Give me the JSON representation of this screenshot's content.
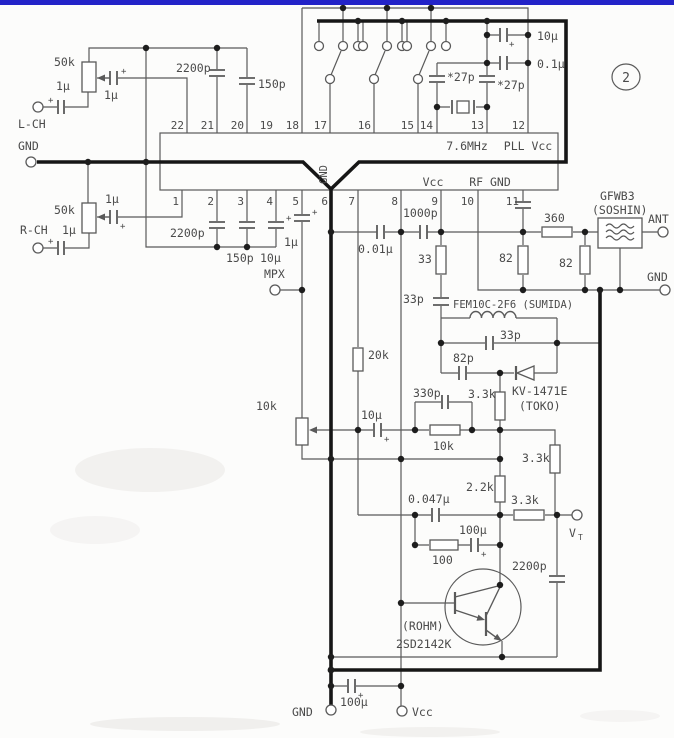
{
  "page": {
    "badge": "2"
  },
  "colors": {
    "top_bar": "#2323c8",
    "line": "#5a5a5a",
    "thick": "#161616",
    "text": "#4a4a4a"
  },
  "symbols": {
    "plus": "+"
  },
  "terminals": {
    "l_ch": "L-CH",
    "gnd_left": "GND",
    "r_ch": "R-CH",
    "mpx": "MPX",
    "vt": "V",
    "vt_sub": "T",
    "ant": "ANT",
    "gnd_right": "GND",
    "gnd_bottom": "GND",
    "vcc_bottom": "Vcc"
  },
  "ic": {
    "pins_top": [
      "22",
      "21",
      "20",
      "19",
      "18",
      "17",
      "16",
      "15",
      "14",
      "13",
      "12"
    ],
    "pins_bottom": [
      "1",
      "2",
      "3",
      "4",
      "5",
      "6",
      "7",
      "8",
      "9",
      "10",
      "11"
    ],
    "xtal_freq": "7.6MHz",
    "pll_vcc": "PLL Vcc",
    "vcc": "Vcc",
    "rf_gnd": "RF GND",
    "gnd": "GND"
  },
  "audio": {
    "pot_l": "50k",
    "cap_l_in": "1μ",
    "cap_l_wiper": "1μ",
    "c2200p_top": "2200p",
    "c150p_top": "150p",
    "pot_r": "50k",
    "cap_r_in": "1μ",
    "cap_r_wiper": "1μ",
    "c2200p_bot": "2200p",
    "c150p_bot": "150p",
    "c10u_pin4": "10μ",
    "c1u_pin5": "1μ"
  },
  "pll": {
    "c10u": "10μ",
    "c01u": "0.1μ",
    "c27p_a": "*27p",
    "c27p_b": "*27p"
  },
  "rf": {
    "c1000p": "1000p",
    "c001u": "0.01μ",
    "r33": "33",
    "c33p_a": "33p",
    "coil": "FEM10C-2F6 (SUMIDA)",
    "c33p_b": "33p",
    "c82p": "82p",
    "varicap": "KV-1471E",
    "varicap_maker": "(TOKO)",
    "r360": "360",
    "r82_a": "82",
    "r82_b": "82",
    "filter": "GFWB3",
    "filter_maker": "(SOSHIN)"
  },
  "tune": {
    "r20k": "20k",
    "pot": "10k",
    "c10u": "10μ",
    "c330p": "330p",
    "r10k": "10k",
    "r3k3_a": "3.3k",
    "r3k3_b": "3.3k",
    "r3k3_c": "3.3k",
    "r2k2": "2.2k",
    "c0047u": "0.047μ",
    "r100": "100",
    "c100u": "100μ",
    "c2200p": "2200p",
    "tr_maker": "(ROHM)",
    "tr_part": "2SD2142K"
  },
  "power": {
    "c100u": "100μ"
  }
}
